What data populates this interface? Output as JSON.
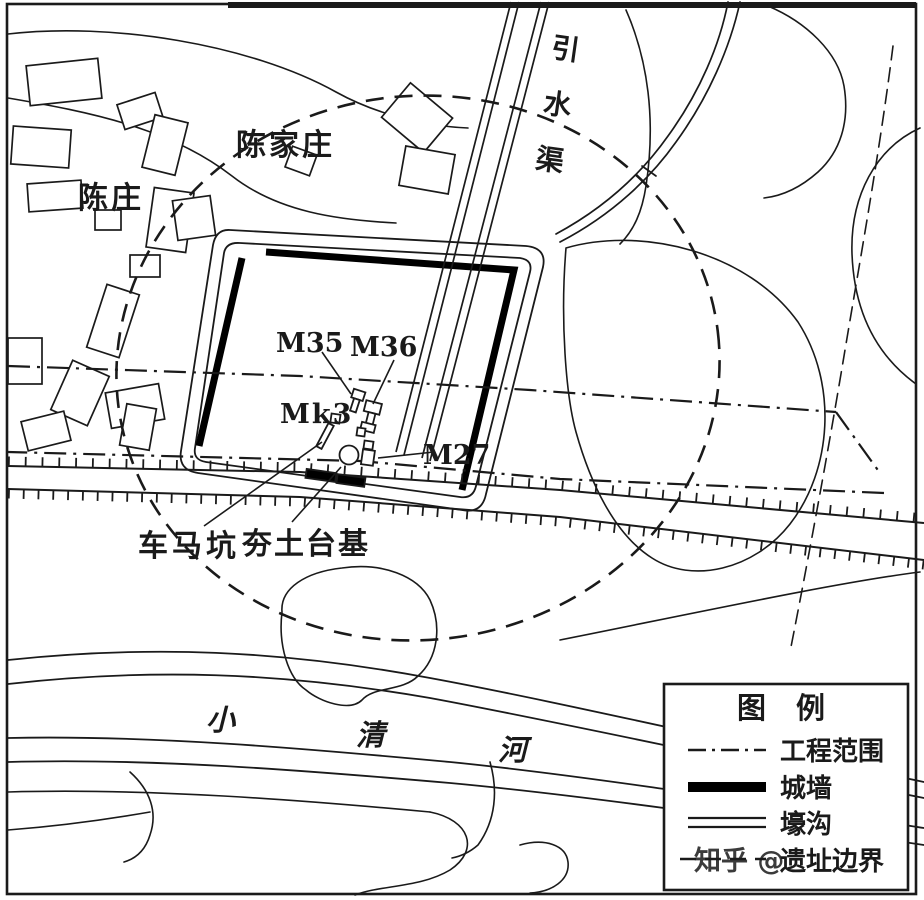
{
  "map": {
    "labels": {
      "village_chenjiazhuang": "陈家庄",
      "village_chenzhuang": "陈庄",
      "channel": "引水渠",
      "river_char_1": "小",
      "river_char_2": "清",
      "river_char_3": "河",
      "tomb_m35": "M35",
      "tomb_m36": "M36",
      "pit_mk3": "Mk3",
      "tomb_m27": "M27",
      "chariot_pit": "车马坑",
      "rammed_earth_platform": "夯土台基"
    }
  },
  "legend": {
    "title": "图 例",
    "items": [
      {
        "label": "工程范围",
        "symbol": "dash-dot-line"
      },
      {
        "label": "城墙",
        "symbol": "thick-line"
      },
      {
        "label": "壕沟",
        "symbol": "double-line"
      },
      {
        "label": "遗址边界",
        "symbol": "dashed-line"
      }
    ]
  },
  "watermark": {
    "text": "知乎 @"
  },
  "colors": {
    "ink": "#1a1a1a",
    "paper": "#ffffff",
    "watermark": "#a0a0a0"
  }
}
